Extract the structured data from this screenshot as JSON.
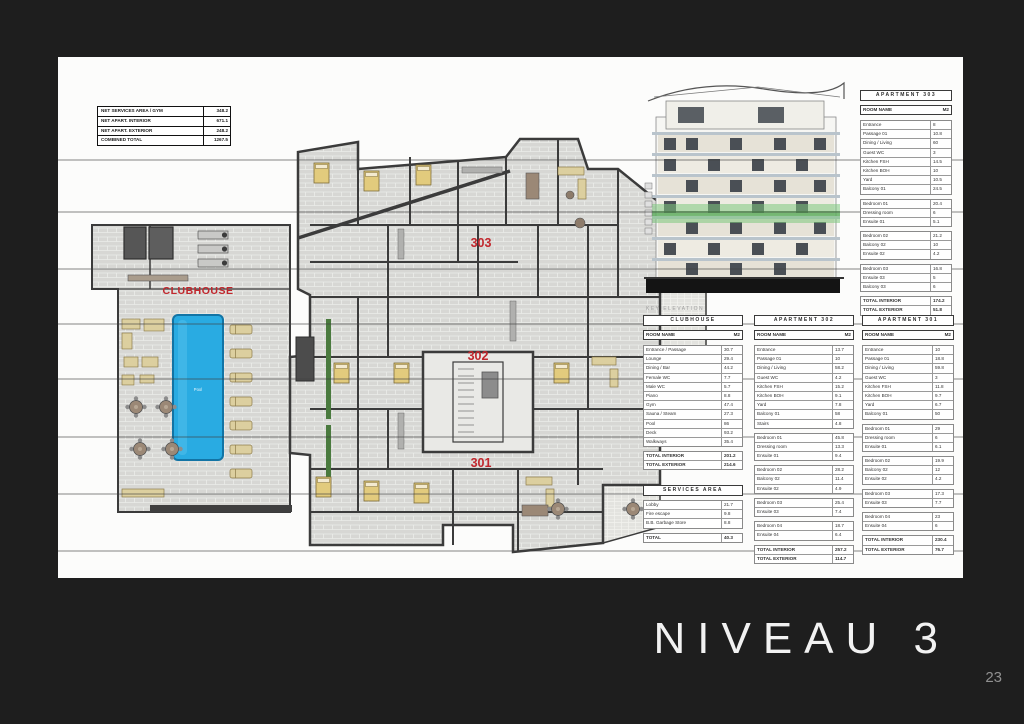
{
  "page": {
    "background": "#1e1e1e",
    "title": "NIVEAU 3",
    "page_number": "23"
  },
  "summary_table": {
    "rows": [
      {
        "label": "NET SERVICES AREA / GYM",
        "value": "348.2"
      },
      {
        "label": "NET APART. INTERIOR",
        "value": "671.1"
      },
      {
        "label": "NET APART. EXTERIOR",
        "value": "248.2"
      },
      {
        "label": "COMBINED TOTAL",
        "value": "1267.5"
      }
    ]
  },
  "floor_plan": {
    "clubhouse_label": "CLUBHOUSE",
    "pool_label": "Pool",
    "apartment_labels": [
      "303",
      "302",
      "301"
    ],
    "accent_red": "#c1272d",
    "pool_blue": "#29abe2",
    "plant_green": "#4a7a3e"
  },
  "elevation": {
    "caption": "KEY ELEVATION",
    "highlight_color": "#7ec87e"
  },
  "area_tables": [
    {
      "id": "apt303",
      "title": "APARTMENT 303",
      "columns": [
        "ROOM NAME",
        "M2"
      ],
      "groups": [
        [
          [
            "Entrance",
            "8"
          ],
          [
            "Passage 01",
            "10.8"
          ],
          [
            "Dining / Living",
            "60"
          ],
          [
            "Guest WC",
            "3"
          ],
          [
            "Kitchen FSH",
            "14.5"
          ],
          [
            "Kitchen BOH",
            "10"
          ],
          [
            "Yard",
            "10.5"
          ],
          [
            "Balcony 01",
            "24.5"
          ]
        ],
        [
          [
            "Bedroom 01",
            "20.4"
          ],
          [
            "Dressing room",
            "6"
          ],
          [
            "Ensuite 01",
            "5.1"
          ]
        ],
        [
          [
            "Bedroom 02",
            "21.2"
          ],
          [
            "Balcony 02",
            "10"
          ],
          [
            "Ensuite 02",
            "4.2"
          ]
        ],
        [
          [
            "Bedroom 03",
            "16.8"
          ],
          [
            "Ensuite 03",
            "5"
          ],
          [
            "Balcony 03",
            "6"
          ]
        ]
      ],
      "totals": [
        [
          "TOTAL INTERIOR",
          "174.2"
        ],
        [
          "TOTAL EXTERIOR",
          "51.8"
        ]
      ]
    },
    {
      "id": "clubhouse",
      "title": "CLUBHOUSE",
      "columns": [
        "ROOM NAME",
        "M2"
      ],
      "groups": [
        [
          [
            "Entrance / Passage",
            "30.7"
          ],
          [
            "Lounge",
            "29.4"
          ],
          [
            "Dining / Bar",
            "44.2"
          ],
          [
            "Female WC",
            "7.7"
          ],
          [
            "Male WC",
            "5.7"
          ],
          [
            "Piano",
            "8.8"
          ],
          [
            "Gym",
            "47.4"
          ],
          [
            "Sauna / Steam",
            "27.3"
          ],
          [
            "Pool",
            "86"
          ],
          [
            "Deck",
            "93.2"
          ],
          [
            "Walkways",
            "35.4"
          ]
        ]
      ],
      "totals": [
        [
          "TOTAL INTERIOR",
          "201.2"
        ],
        [
          "TOTAL EXTERIOR",
          "214.6"
        ]
      ]
    },
    {
      "id": "apt302",
      "title": "APARTMENT 302",
      "columns": [
        "ROOM NAME",
        "M2"
      ],
      "groups": [
        [
          [
            "Entrance",
            "13.7"
          ],
          [
            "Passage 01",
            "10"
          ],
          [
            "Dining / Living",
            "58.2"
          ],
          [
            "Guest WC",
            "4.2"
          ],
          [
            "Kitchen FSH",
            "15.2"
          ],
          [
            "Kitchen BOH",
            "9.1"
          ],
          [
            "Yard",
            "7.8"
          ],
          [
            "Balcony 01",
            "58"
          ],
          [
            "Stairs",
            "4.8"
          ]
        ],
        [
          [
            "Bedroom 01",
            "45.8"
          ],
          [
            "Dressing room",
            "13.3"
          ],
          [
            "Ensuite 01",
            "9.4"
          ]
        ],
        [
          [
            "Bedroom 02",
            "28.2"
          ],
          [
            "Balcony 02",
            "11.4"
          ],
          [
            "Ensuite 02",
            "4.9"
          ]
        ],
        [
          [
            "Bedroom 03",
            "25.4"
          ],
          [
            "Ensuite 03",
            "7.4"
          ]
        ],
        [
          [
            "Bedroom 04",
            "18.7"
          ],
          [
            "Ensuite 04",
            "6.4"
          ]
        ]
      ],
      "totals": [
        [
          "TOTAL INTERIOR",
          "257.2"
        ],
        [
          "TOTAL EXTERIOR",
          "114.7"
        ]
      ]
    },
    {
      "id": "apt301",
      "title": "APARTMENT 301",
      "columns": [
        "ROOM NAME",
        "M2"
      ],
      "groups": [
        [
          [
            "Entrance",
            "10"
          ],
          [
            "Passage 01",
            "18.8"
          ],
          [
            "Dining / Living",
            "59.8"
          ],
          [
            "Guest WC",
            "3"
          ],
          [
            "Kitchen FSH",
            "11.8"
          ],
          [
            "Kitchen BOH",
            "9.7"
          ],
          [
            "Yard",
            "6.7"
          ],
          [
            "Balcony 01",
            "50"
          ]
        ],
        [
          [
            "Bedroom 01",
            "29"
          ],
          [
            "Dressing room",
            "6"
          ],
          [
            "Ensuite 01",
            "6.1"
          ]
        ],
        [
          [
            "Bedroom 02",
            "19.9"
          ],
          [
            "Balcony 02",
            "12"
          ],
          [
            "Ensuite 02",
            "4.2"
          ]
        ],
        [
          [
            "Bedroom 03",
            "17.3"
          ],
          [
            "Ensuite 03",
            "7.7"
          ]
        ],
        [
          [
            "Bedroom 04",
            "23"
          ],
          [
            "Ensuite 04",
            "6"
          ]
        ]
      ],
      "totals": [
        [
          "TOTAL INTERIOR",
          "230.4"
        ],
        [
          "TOTAL EXTERIOR",
          "76.7"
        ]
      ]
    },
    {
      "id": "services",
      "title": "SERVICES AREA",
      "columns": null,
      "groups": [
        [
          [
            "Lobby",
            "21.7"
          ],
          [
            "Fire escape",
            "9.8"
          ],
          [
            "B.B. Garbage Store",
            "8.8"
          ]
        ]
      ],
      "totals": [
        [
          "TOTAL",
          "40.3"
        ]
      ]
    }
  ]
}
